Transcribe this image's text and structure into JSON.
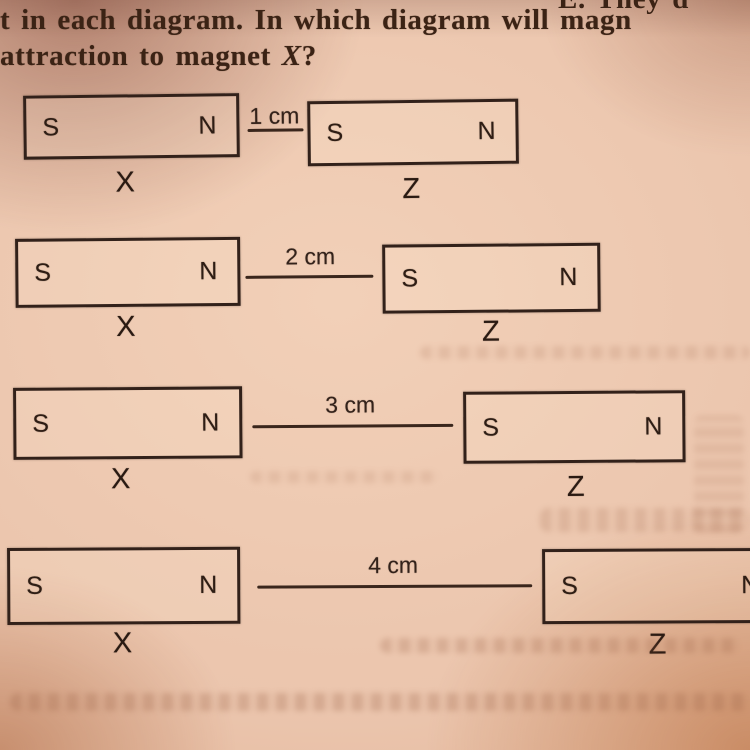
{
  "page": {
    "question_line1": "t in each diagram. In which diagram will magn",
    "question_line2": {
      "prefix": "attraction to magnet ",
      "variable": "X",
      "suffix": "?"
    },
    "corner_fragment": "E. They d"
  },
  "diagrams": [
    {
      "name": "diagram-1cm",
      "distance": "1 cm",
      "magnet_x": {
        "label": "X",
        "left_pole": "S",
        "right_pole": "N"
      },
      "magnet_z": {
        "label": "Z",
        "left_pole": "S",
        "right_pole": "N"
      }
    },
    {
      "name": "diagram-2cm",
      "distance": "2 cm",
      "magnet_x": {
        "label": "X",
        "left_pole": "S",
        "right_pole": "N"
      },
      "magnet_z": {
        "label": "Z",
        "left_pole": "S",
        "right_pole": "N"
      }
    },
    {
      "name": "diagram-3cm",
      "distance": "3 cm",
      "magnet_x": {
        "label": "X",
        "left_pole": "S",
        "right_pole": "N"
      },
      "magnet_z": {
        "label": "Z",
        "left_pole": "S",
        "right_pole": "N"
      }
    },
    {
      "name": "diagram-4cm",
      "distance": "4 cm",
      "magnet_x": {
        "label": "X",
        "left_pole": "S",
        "right_pole": "N"
      },
      "magnet_z": {
        "label": "Z",
        "left_pole": "S",
        "right_pole": "N"
      }
    }
  ],
  "colors": {
    "paper": "#ebc5ad",
    "ink": "#32211a",
    "question_text": "#3b2315",
    "bleed_through": "#9b6246"
  }
}
